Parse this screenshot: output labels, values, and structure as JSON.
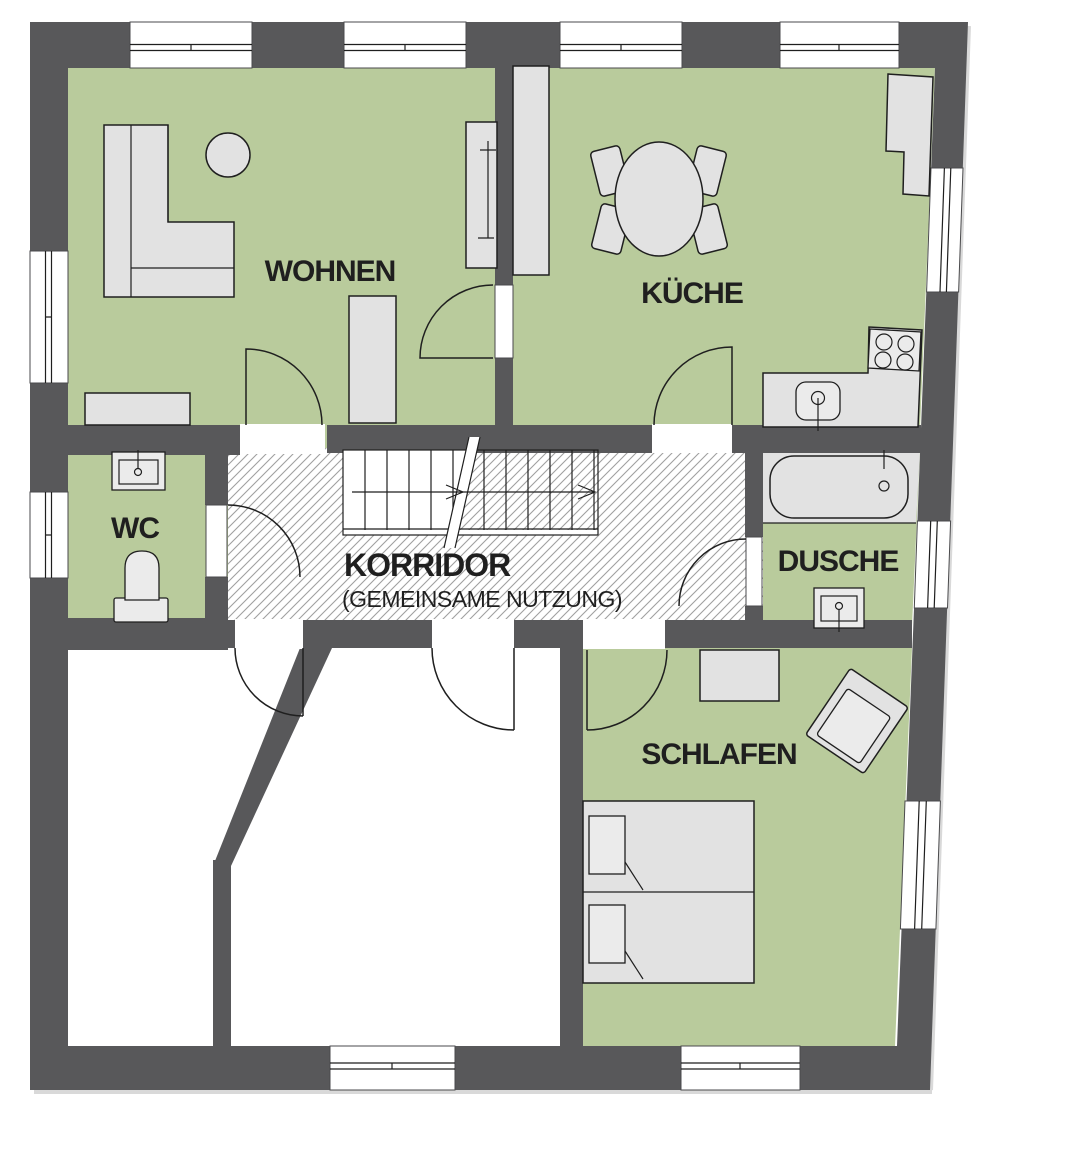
{
  "plan_title": "Grundriss Wohnung",
  "rooms": [
    {
      "id": "wohnen",
      "label": "WOHNEN"
    },
    {
      "id": "kueche",
      "label": "KÜCHE"
    },
    {
      "id": "wc",
      "label": "WC"
    },
    {
      "id": "korridor",
      "label": "KORRIDOR",
      "sublabel": "(GEMEINSAME NUTZUNG)"
    },
    {
      "id": "dusche",
      "label": "DUSCHE"
    },
    {
      "id": "schlafen",
      "label": "SCHLAFEN"
    }
  ],
  "colors": {
    "paper": "#ffffff",
    "wall": "#58585a",
    "floor_green": "#b9cb9c",
    "furniture": "#e2e2e2",
    "furniture_light": "#ebebeb",
    "hatch": "#a0a0a0",
    "line": "#1f1f1f",
    "shadow": "#d9d9d9"
  }
}
